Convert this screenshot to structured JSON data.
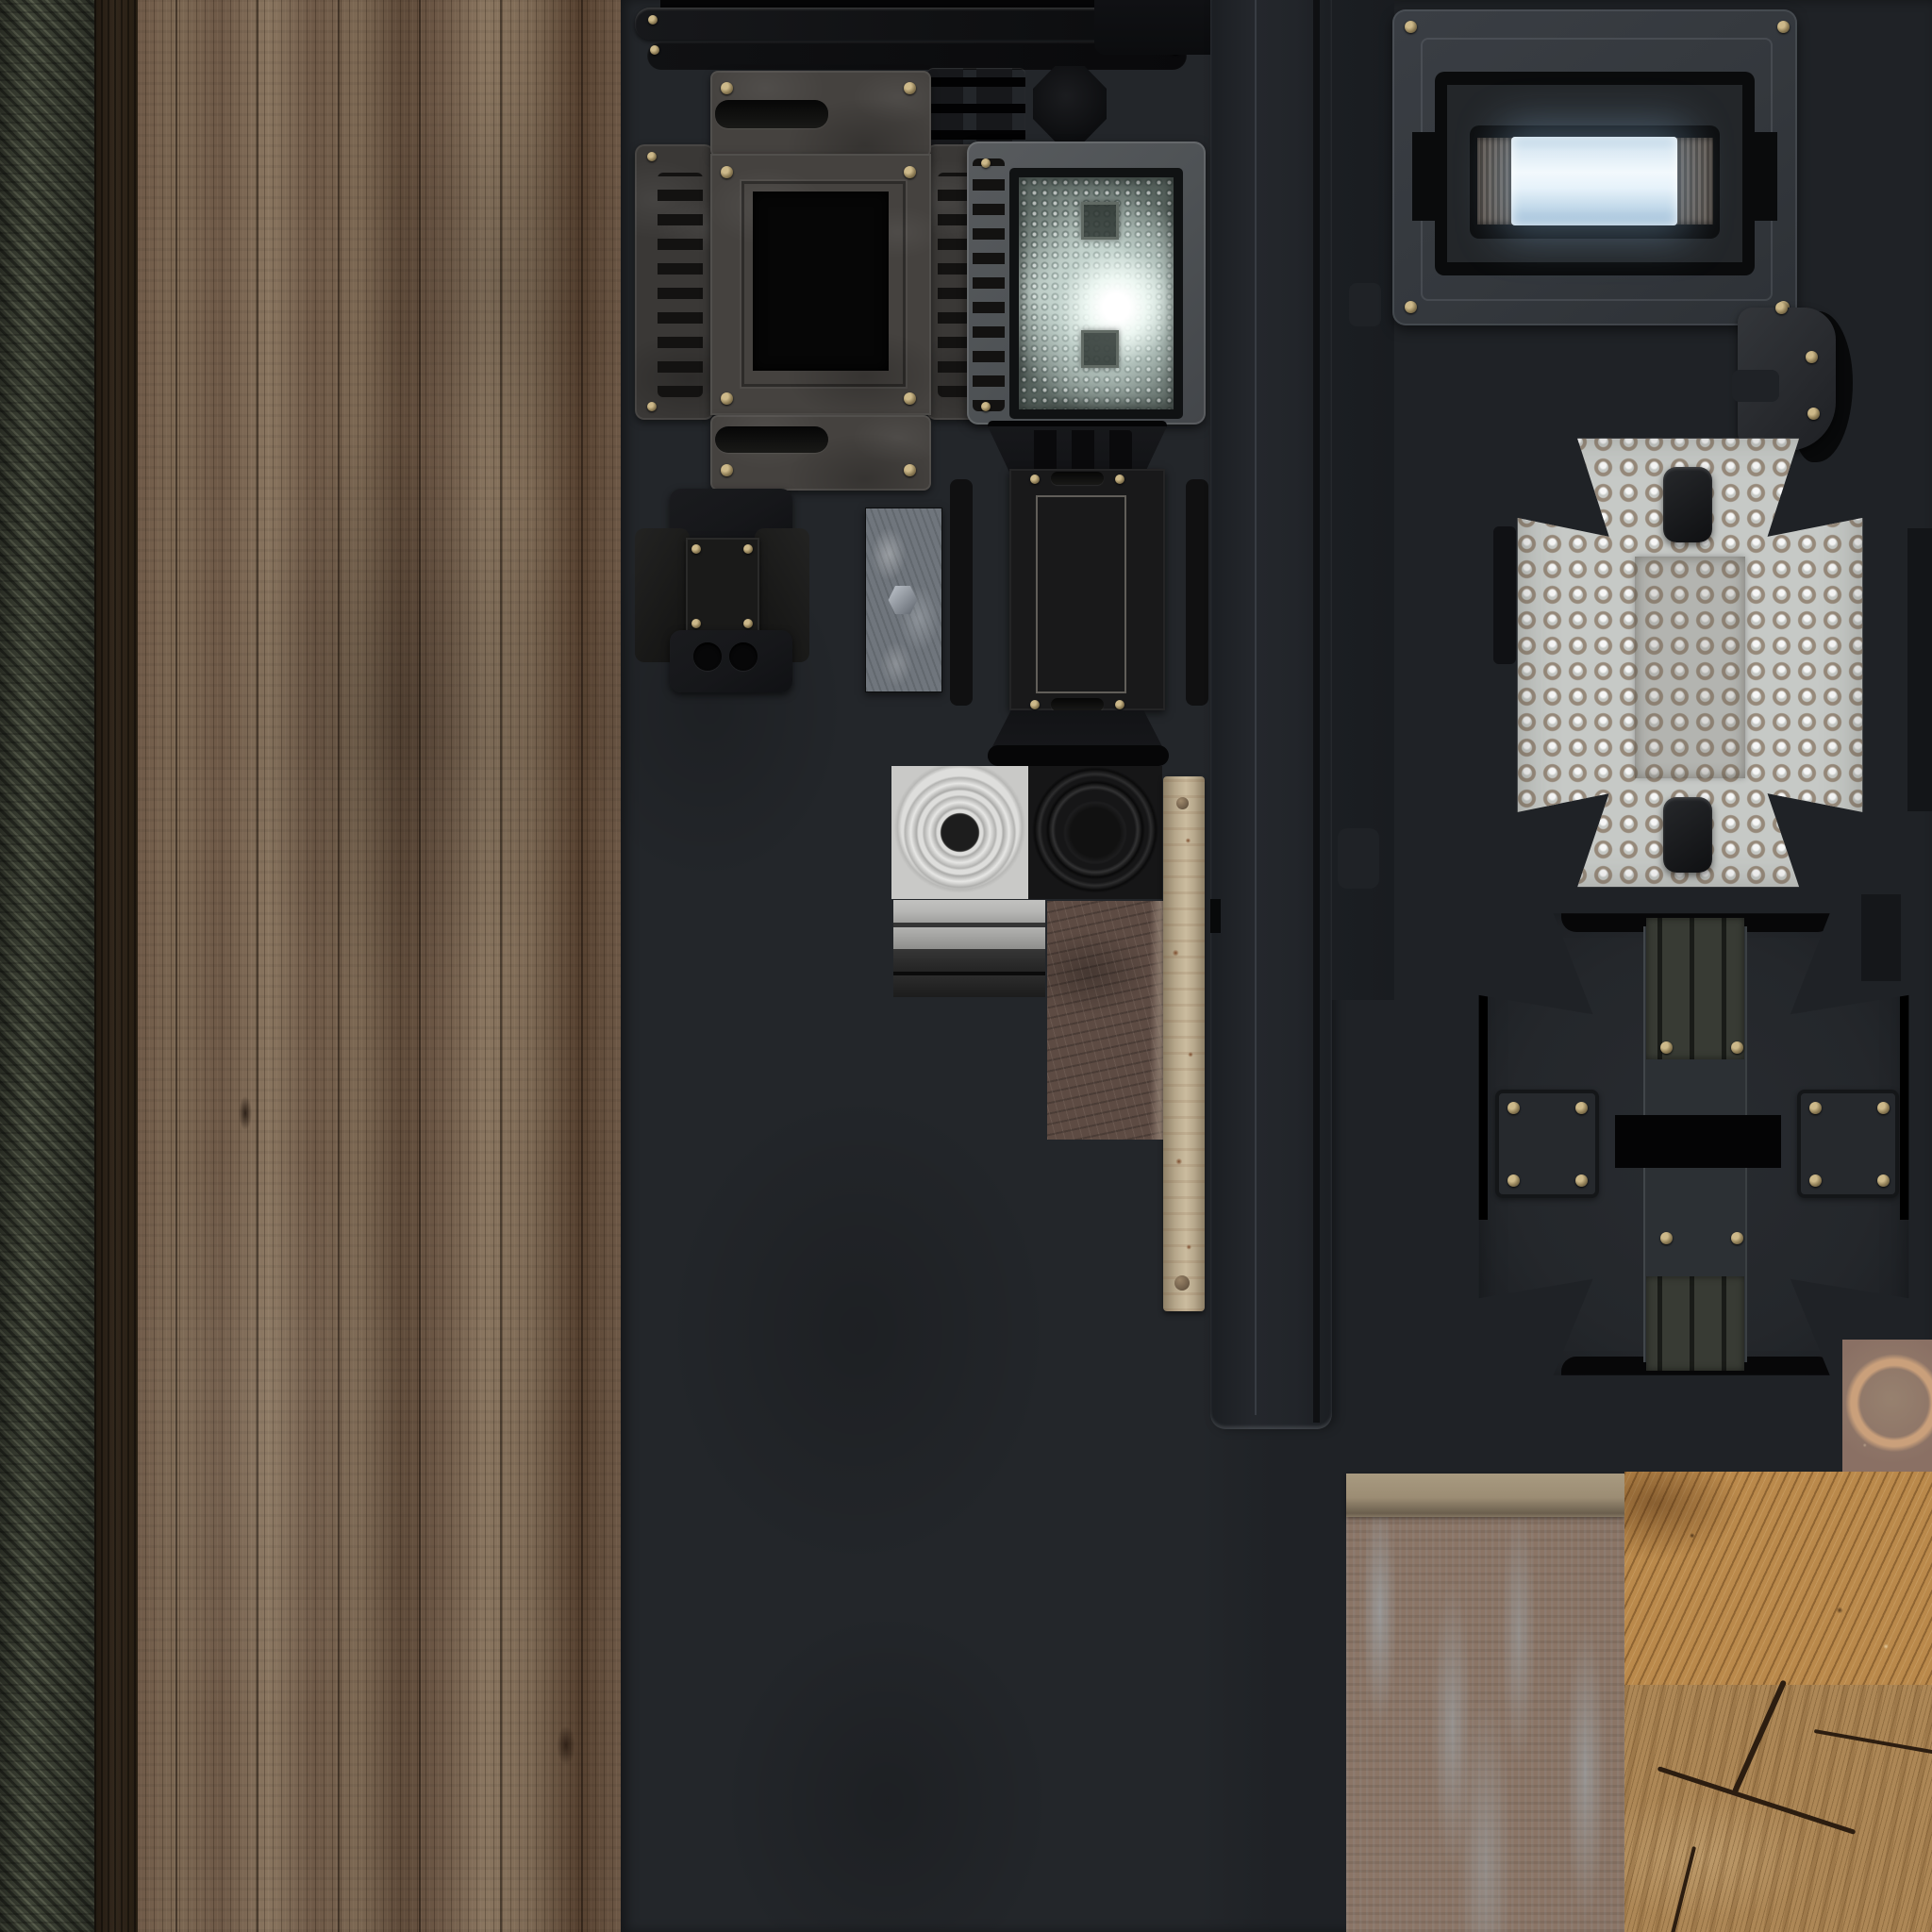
{
  "meta": {
    "kind": "texture-atlas-sheet",
    "description": "3D game asset texture atlas: diagonal ribbed fabric strip, weathered vertical wood planks, dark slate sheet holding machine parts (vented screen panel, lit spotlight reflector, brackets, galvanized plate, speaker discs, leather and wood swatches), glowing blue tube panel, dimpled cross armor plate with dark back-side plate, and rust/wood material squares",
    "visible_text": "none"
  },
  "palette": {
    "bg_page": "#17191c",
    "bg_dark": "#23262a",
    "bg_dark_right": "#1f2226",
    "stripe_dark": "#272a22",
    "stripe_mid": "#3e4336",
    "stripe_light": "#5a5f4e",
    "bark": "#32271c",
    "wood_1": "#55402f",
    "wood_2": "#6e5947",
    "wood_3": "#7d6954",
    "wood_4": "#8a7660",
    "wood_5": "#5f4b3a",
    "metal_panel": "#45423f",
    "metal_panel_dark": "#3a3836",
    "vent_slot": "#131211",
    "window_black": "#060606",
    "spot_frame": "#4e5255",
    "reflector_base": "#b3c1bb",
    "part_dark": "#16171a",
    "part_darker": "#0e0f11",
    "galv_base": "#70767d",
    "tile_white": "#c9c9c7",
    "tile_ring": "#e7e7e5",
    "tile_dot": "#1d1d1d",
    "tile_black": "#161617",
    "bar_light": "#b5b5b3",
    "bar_gray": "#8f8f8d",
    "bar_dark": "#2d2d2d",
    "bar_black": "#1c1c1c",
    "leather": "#5d4b43",
    "stick": "#b7a88c",
    "stick_edge": "#8d7f66",
    "rust_spot": "#7c4a2b",
    "column": "#1f2227",
    "column_face": "#24272c",
    "seam": "#59606a",
    "frame_gray": "#34383d",
    "bezel_black": "#0a0b0c",
    "panel_inner": "#232629",
    "glow_top": "#b9d2e4",
    "glow_mid": "#f2f9fd",
    "glow_bot": "#9dbcd6",
    "cap_brown": "#6a6159",
    "dots_base": "#c6c9c6",
    "dots_ring": "#96897a",
    "cross_dark": "#24272b",
    "spine": "#2c3034",
    "groove": "#383b34",
    "pure_black": "#050506",
    "brass": "#cdb98a",
    "rust_base": "#8a7064",
    "rust_ring": "#caa07b",
    "panel_face": "#8b7566",
    "panel_lip": "#9c8d74",
    "chip_blue": "#a8b9c4",
    "wood_orange": "#ba894b",
    "wood_end": "#ad8756",
    "crack": "#2c1d10"
  },
  "regions": [
    {
      "id": "ribbed-fabric-strip",
      "label": "dark olive diagonal ribbed fabric, full height, far left"
    },
    {
      "id": "wood-plank-sheet",
      "label": "weathered brown vertical wood planks with bark edge, full height"
    },
    {
      "id": "dark-sheet",
      "label": "charcoal slate background holding machine parts"
    },
    {
      "id": "top-rail-bars",
      "label": "two dark riveted rails along the top"
    },
    {
      "id": "vented-screen-panel",
      "label": "gray panel with black screen window, side vent wings, screws"
    },
    {
      "id": "spotlight",
      "label": "gray-framed faceted reflector lamp, lit white hotspot, slot strip"
    },
    {
      "id": "strap-bracket",
      "label": "dark cross-shaped bracket with screws and two round holes"
    },
    {
      "id": "galvanized-plate",
      "label": "mottled zinc plate with hex bolt"
    },
    {
      "id": "dark-flap-box",
      "label": "black unfolded box with slotted trapezoid flaps and chalked plate"
    },
    {
      "id": "white-speaker-tile",
      "label": "white concentric-ring disc with black center"
    },
    {
      "id": "black-speaker-tile",
      "label": "black concentric-ring speaker back"
    },
    {
      "id": "gray-bar-stack",
      "label": "stacked light-to-dark horizontal trim bars"
    },
    {
      "id": "leather-swatch",
      "label": "scratched brown leather rectangle"
    },
    {
      "id": "wood-stick",
      "label": "pale wooden slat with rust speckles and rivets"
    },
    {
      "id": "machined-column",
      "label": "tall dark machined column with seams and notches"
    },
    {
      "id": "glow-tube-panel",
      "label": "screwed gray frame, black bezel, glowing blue tube with ridged caps"
    },
    {
      "id": "wedge-bracket",
      "label": "dark wedge bracket with three brass screws"
    },
    {
      "id": "dimpled-cross-plate",
      "label": "light gray bump-dot Maltese-cross plate with two black pads"
    },
    {
      "id": "dark-cross-back",
      "label": "dark cross back plate: grooved spine, black bar, bolted side plates"
    },
    {
      "id": "rust-ring-square",
      "label": "rusty square with copper ring stain"
    },
    {
      "id": "weathered-paint-panel",
      "label": "taupe panel with pale blue chipped paint and top lip"
    },
    {
      "id": "rough-sawn-wood",
      "label": "orange rough-sawn wood block"
    },
    {
      "id": "cracked-end-grain",
      "label": "cracked wood end-grain block"
    }
  ]
}
